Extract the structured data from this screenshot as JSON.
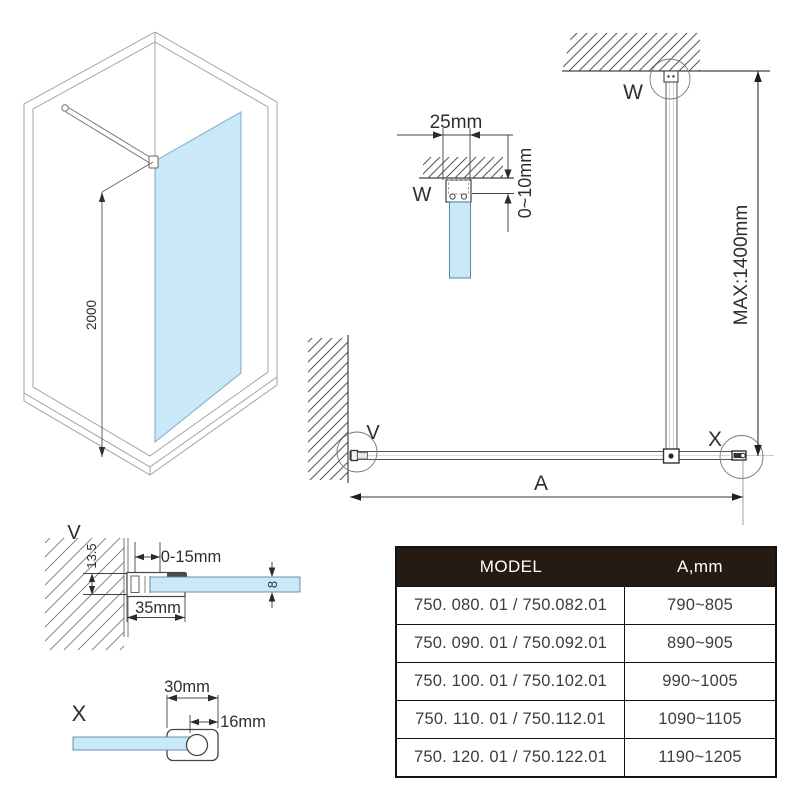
{
  "drawing": {
    "iso": {
      "height_label": "2000"
    },
    "detail_w": {
      "marker": "W",
      "width_label": "25mm",
      "gap_label": "0~10mm"
    },
    "assembly": {
      "ceiling_marker": "W",
      "wall_marker": "V",
      "end_marker": "X",
      "bar_length_label": "MAX:1400mm",
      "width_label": "A"
    },
    "detail_v": {
      "marker": "V",
      "profile_depth_label": "13.5",
      "adjust_range_label": "0-15mm",
      "profile_width_label": "35mm",
      "glass_thickness_label": "8"
    },
    "detail_x": {
      "marker": "X",
      "profile_width_label": "30mm",
      "tube_diameter_label": "16mm"
    }
  },
  "table": {
    "headers": [
      "MODEL",
      "A,mm"
    ],
    "rows": [
      {
        "model": "750. 080. 01 / 750.082.01",
        "a_mm": "790~805"
      },
      {
        "model": "750. 090. 01 / 750.092.01",
        "a_mm": "890~905"
      },
      {
        "model": "750. 100. 01 / 750.102.01",
        "a_mm": "990~1005"
      },
      {
        "model": "750. 110. 01 / 750.112.01",
        "a_mm": "1090~1105"
      },
      {
        "model": "750. 120. 01 / 750.122.01",
        "a_mm": "1190~1205"
      }
    ]
  },
  "colors": {
    "glass": "#c9e9f9",
    "line": "#4a4a4a",
    "wireframe": "#9a9a9a",
    "table_header_bg": "#251b13",
    "table_header_text": "#ffffff"
  }
}
